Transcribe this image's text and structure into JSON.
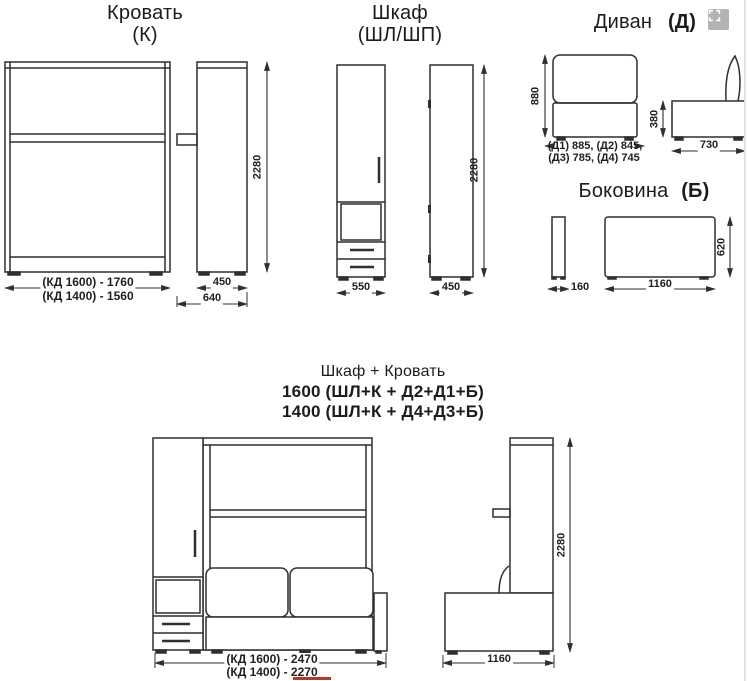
{
  "canvas": {
    "background": "#ffffff",
    "line_color": "#2f2f2f",
    "accent_red": "#b03a2e"
  },
  "icons": {
    "expand_icon": "fullscreen-expand"
  },
  "bed": {
    "title": "Кровать",
    "code": "(К)",
    "dim_width_1600": "(КД 1600) - 1760",
    "dim_width_1400": "(КД 1400) - 1560",
    "dim_height": "2280",
    "dim_depth_body": "450",
    "dim_depth_total": "640"
  },
  "cabinet": {
    "title": "Шкаф",
    "code": "(ШЛ/ШП)",
    "dim_width": "550",
    "dim_depth": "450",
    "dim_height": "2280"
  },
  "sofa": {
    "title": "Диван",
    "code": "(Д)",
    "dim_height": "880",
    "dim_widths_line1": "(Д1) 885, (Д2) 845,",
    "dim_widths_line2": "(Д3) 785, (Д4) 745",
    "dim_seat_height": "380",
    "dim_depth": "730"
  },
  "side_panel": {
    "title": "Боковина",
    "code": "(Б)",
    "dim_thickness": "160",
    "dim_length": "1160",
    "dim_height": "620"
  },
  "combo": {
    "title": "Шкаф + Кровать",
    "variant_1600": "1600 (ШЛ+К + Д2+Д1+Б)",
    "variant_1400": "1400 (ШЛ+К + Д4+Д3+Б)",
    "dim_width_1600": "(КД 1600) - 2470",
    "dim_width_1400": "(КД 1400) - 2270",
    "dim_depth": "1160",
    "dim_height": "2280"
  }
}
